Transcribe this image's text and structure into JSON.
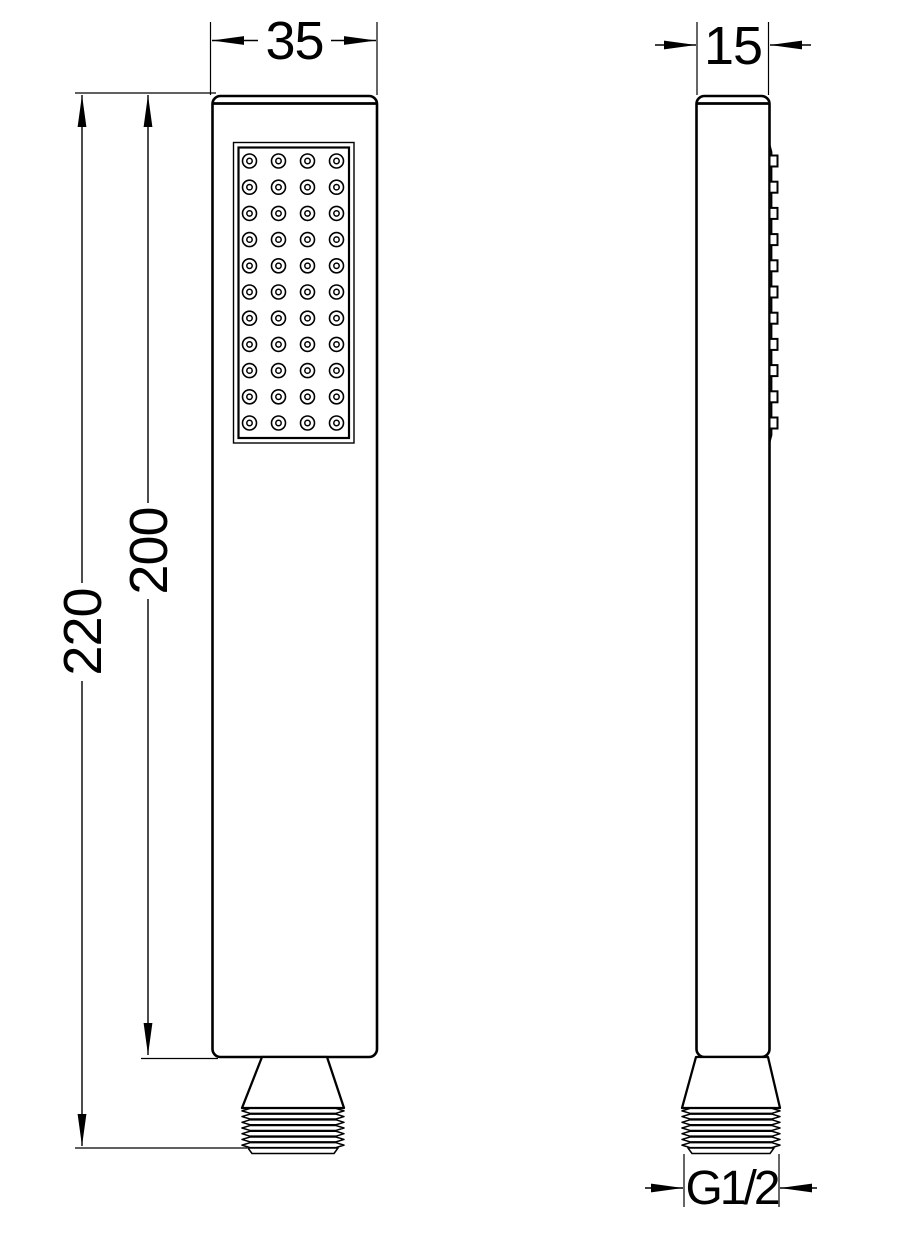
{
  "drawing": {
    "kind": "hand-shower technical drawing",
    "colors": {
      "line": "#000000",
      "background": "#ffffff"
    },
    "front_view": {
      "dimensions": {
        "width": "35",
        "overall_height": "220",
        "body_height": "200"
      },
      "nozzle_grid": {
        "rows": 11,
        "cols": 4
      }
    },
    "side_view": {
      "dimensions": {
        "depth": "15",
        "thread": "G1/2"
      },
      "nozzle_bumps": 11
    }
  }
}
